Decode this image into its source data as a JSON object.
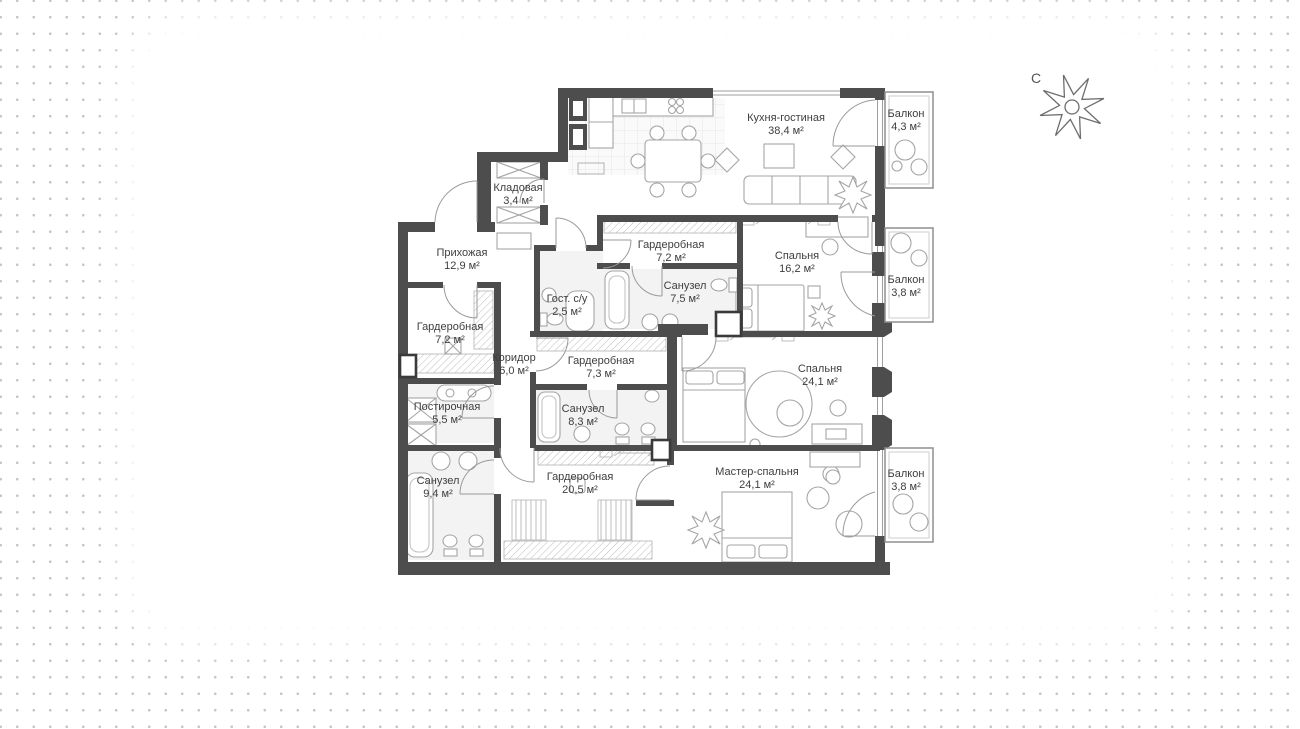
{
  "floor_plan": {
    "compass": {
      "north_label": "С"
    },
    "colors": {
      "walls": "#4d4d4d",
      "furniture_lines": "#a5a5a5",
      "label_text": "#3e3e3e",
      "background_dots": "#c4c4c4"
    },
    "rooms": [
      {
        "id": "kitchen-living",
        "name": "Кухня-гостиная",
        "area": "38,4 м²"
      },
      {
        "id": "balcony-top",
        "name": "Балкон",
        "area": "4,3 м²"
      },
      {
        "id": "storage",
        "name": "Кладовая",
        "area": "3,4 м²"
      },
      {
        "id": "hallway",
        "name": "Прихожая",
        "area": "12,9 м²"
      },
      {
        "id": "wardrobe-center",
        "name": "Гардеробная",
        "area": "7,2 м²"
      },
      {
        "id": "bedroom-16",
        "name": "Спальня",
        "area": "16,2 м²"
      },
      {
        "id": "balcony-middle",
        "name": "Балкон",
        "area": "3,8 м²"
      },
      {
        "id": "bathroom-75",
        "name": "Санузел",
        "area": "7,5 м²"
      },
      {
        "id": "guest-wc",
        "name": "Гост. с/у",
        "area": "2,5 м²"
      },
      {
        "id": "wardrobe-left",
        "name": "Гардеробная",
        "area": "7,2 м²"
      },
      {
        "id": "corridor",
        "name": "Коридор",
        "area": "6,0 м²"
      },
      {
        "id": "wardrobe-73",
        "name": "Гардеробная",
        "area": "7,3 м²"
      },
      {
        "id": "bedroom-24",
        "name": "Спальня",
        "area": "24,1 м²"
      },
      {
        "id": "laundry",
        "name": "Постирочная",
        "area": "5,5 м²"
      },
      {
        "id": "bathroom-83",
        "name": "Санузел",
        "area": "8,3 м²"
      },
      {
        "id": "bathroom-94",
        "name": "Санузел",
        "area": "9,4 м²"
      },
      {
        "id": "wardrobe-205",
        "name": "Гардеробная",
        "area": "20,5 м²"
      },
      {
        "id": "master-bedroom",
        "name": "Мастер-спальня",
        "area": "24,1 м²"
      },
      {
        "id": "balcony-bottom",
        "name": "Балкон",
        "area": "3,8 м²"
      }
    ]
  }
}
